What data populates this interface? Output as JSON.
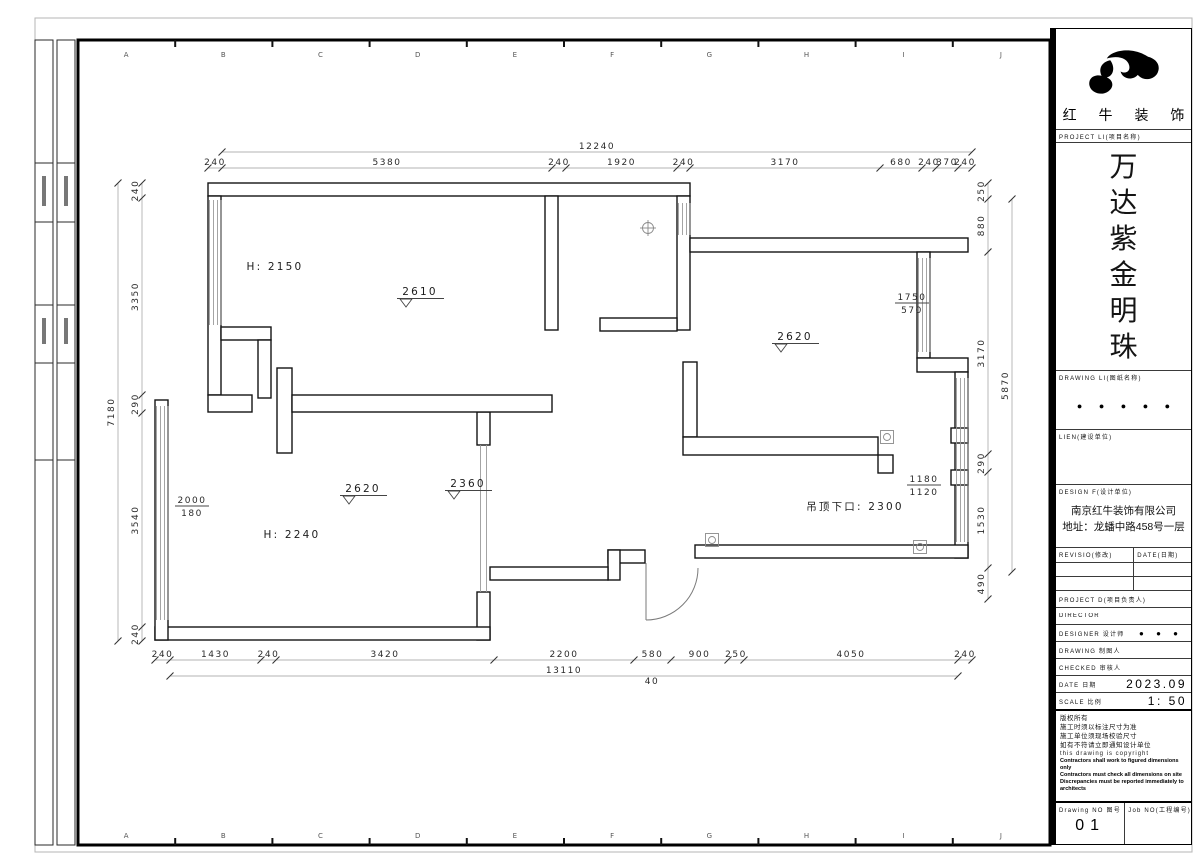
{
  "frame": {
    "grid_letters": [
      "A",
      "B",
      "C",
      "D",
      "E",
      "F",
      "G",
      "H",
      "I",
      "J"
    ]
  },
  "title_block": {
    "logo_text": "红 牛 装 饰",
    "project_label": "PROJECT LI(项目名称)",
    "project_name_chars": [
      "万",
      "达",
      "紫",
      "金",
      "明",
      "珠"
    ],
    "drawing_list_label": "DRAWING LI(图纸名称)",
    "drawing_list_dots": "● ● ● ● ●",
    "client_label": "LIEN(建设单位)",
    "design_firm_label": "DESIGN F(设计单位)",
    "design_firm_name": "南京红牛装饰有限公司",
    "design_firm_address": "地址：龙蟠中路458号一层",
    "revision_label": "REVISIO(修改)",
    "revision_date_label": "DATE(日期)",
    "project_director_label": "PROJECT D(项目负责人)",
    "director_label": "DIRECTOR",
    "designer_label": "DESIGNER 设计师",
    "designer_value": "● ● ●",
    "drawing_by_label": "DRAWING 制图人",
    "checked_label": "CHECKED 审核人",
    "date_label": "DATE 日期",
    "date_value": "2023.09",
    "scale_label": "SCALE 比例",
    "scale_value": "1: 50",
    "notes": [
      "版权所有",
      "施工时须以标注尺寸为准",
      "施工单位须现场校验尺寸",
      "如有不符请立即通知设计单位",
      "this drawing is copyright",
      "Contractors shall work to figured dimensions only",
      "Contractors must check all dimensions on site",
      "Discrepancies must be reported immediately to architects"
    ],
    "drawing_no_label": "Drawing NO 图号",
    "drawing_no_value": "01",
    "job_no_label": "Job NO(工程编号)"
  },
  "plan": {
    "dimensions": [
      {
        "name": "top-overall",
        "orient": "h",
        "pos": 152,
        "segments": [
          {
            "label": "12240",
            "from": 222,
            "to": 972
          }
        ]
      },
      {
        "name": "top-row",
        "orient": "h",
        "pos": 168,
        "segments": [
          {
            "label": "240",
            "from": 208,
            "to": 222
          },
          {
            "label": "5380",
            "from": 222,
            "to": 552
          },
          {
            "label": "240",
            "from": 552,
            "to": 566
          },
          {
            "label": "1920",
            "from": 566,
            "to": 677
          },
          {
            "label": "240",
            "from": 677,
            "to": 690
          },
          {
            "label": "3170",
            "from": 690,
            "to": 880
          },
          {
            "label": "680",
            "from": 880,
            "to": 922
          },
          {
            "label": "240",
            "from": 922,
            "to": 936
          },
          {
            "label": "370",
            "from": 936,
            "to": 958
          },
          {
            "label": "240",
            "from": 958,
            "to": 972
          }
        ]
      },
      {
        "name": "left-outer",
        "orient": "v",
        "pos": 118,
        "segments": [
          {
            "label": "7180",
            "from": 183,
            "to": 641
          }
        ]
      },
      {
        "name": "left-row",
        "orient": "v",
        "pos": 142,
        "segments": [
          {
            "label": "240",
            "from": 183,
            "to": 198
          },
          {
            "label": "3350",
            "from": 198,
            "to": 395
          },
          {
            "label": "290",
            "from": 395,
            "to": 413
          },
          {
            "label": "3540",
            "from": 413,
            "to": 627
          },
          {
            "label": "240",
            "from": 627,
            "to": 641
          }
        ]
      },
      {
        "name": "right-row",
        "orient": "v",
        "pos": 988,
        "segments": [
          {
            "label": "250",
            "from": 183,
            "to": 199
          },
          {
            "label": "880",
            "from": 199,
            "to": 252
          },
          {
            "label": "3170",
            "from": 252,
            "to": 454
          },
          {
            "label": "290",
            "from": 454,
            "to": 472
          },
          {
            "label": "1530",
            "from": 472,
            "to": 568
          },
          {
            "label": "490",
            "from": 568,
            "to": 599
          }
        ]
      },
      {
        "name": "right-outer",
        "orient": "v",
        "pos": 1012,
        "segments": [
          {
            "label": "5870",
            "from": 199,
            "to": 572
          }
        ]
      },
      {
        "name": "bottom-row",
        "orient": "h",
        "pos": 660,
        "segments": [
          {
            "label": "240",
            "from": 155,
            "to": 170
          },
          {
            "label": "1430",
            "from": 170,
            "to": 261
          },
          {
            "label": "240",
            "from": 261,
            "to": 276
          },
          {
            "label": "3420",
            "from": 276,
            "to": 494
          },
          {
            "label": "2200",
            "from": 494,
            "to": 634
          },
          {
            "label": "580",
            "from": 634,
            "to": 671
          },
          {
            "label": "900",
            "from": 671,
            "to": 728
          },
          {
            "label": "250",
            "from": 728,
            "to": 744
          },
          {
            "label": "4050",
            "from": 744,
            "to": 958
          },
          {
            "label": "240",
            "from": 958,
            "to": 972
          }
        ]
      },
      {
        "name": "bottom-overall",
        "orient": "h",
        "pos": 676,
        "segments": [
          {
            "label": "13110",
            "from": 170,
            "to": 958
          }
        ]
      }
    ],
    "extra_texts": [
      {
        "text": "40",
        "x": 652,
        "y": 684
      }
    ],
    "labels": [
      {
        "type": "plain",
        "text": "H: 2150",
        "x": 275,
        "y": 270
      },
      {
        "type": "plain",
        "text": "H: 2240",
        "x": 292,
        "y": 538
      },
      {
        "type": "plain",
        "text": "吊顶下口: 2300",
        "x": 855,
        "y": 510
      },
      {
        "type": "elev",
        "text": "2610",
        "x": 417,
        "y": 295
      },
      {
        "type": "elev",
        "text": "2620",
        "x": 360,
        "y": 492
      },
      {
        "type": "elev",
        "text": "2360",
        "x": 465,
        "y": 487
      },
      {
        "type": "elev",
        "text": "2620",
        "x": 792,
        "y": 340
      },
      {
        "type": "stacked",
        "text": "2000",
        "sub": "180",
        "x": 192,
        "y": 503
      },
      {
        "type": "stacked",
        "text": "1750",
        "sub": "570",
        "x": 912,
        "y": 300
      },
      {
        "type": "stacked",
        "text": "1180",
        "sub": "1120",
        "x": 924,
        "y": 482
      }
    ],
    "symbols": [
      {
        "type": "circle-cross",
        "x": 648,
        "y": 228
      },
      {
        "type": "square",
        "x": 712,
        "y": 540
      },
      {
        "type": "square",
        "x": 887,
        "y": 437
      },
      {
        "type": "square",
        "x": 920,
        "y": 547
      }
    ]
  }
}
